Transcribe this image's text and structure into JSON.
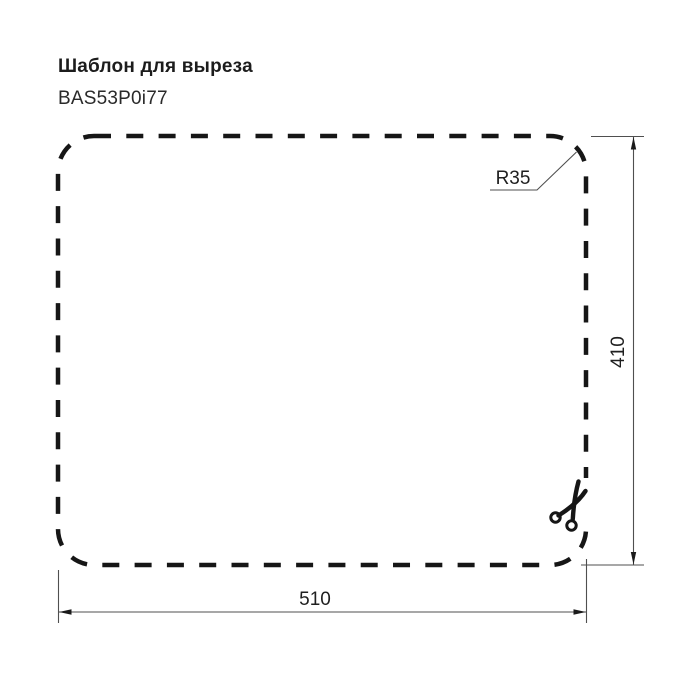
{
  "header": {
    "title": "Шаблон для выреза",
    "model": "BAS53P0i77"
  },
  "diagram": {
    "kind": "sink-cutout-template",
    "radius_label": "R35",
    "width_label": "510",
    "height_label": "410",
    "outline_color": "#161616",
    "dimension_color": "#4f4f4f",
    "arrow_color": "#1a1a1a",
    "icon_color": "#161616",
    "background_color": "#ffffff",
    "icons": [
      "scissors-icon"
    ]
  }
}
